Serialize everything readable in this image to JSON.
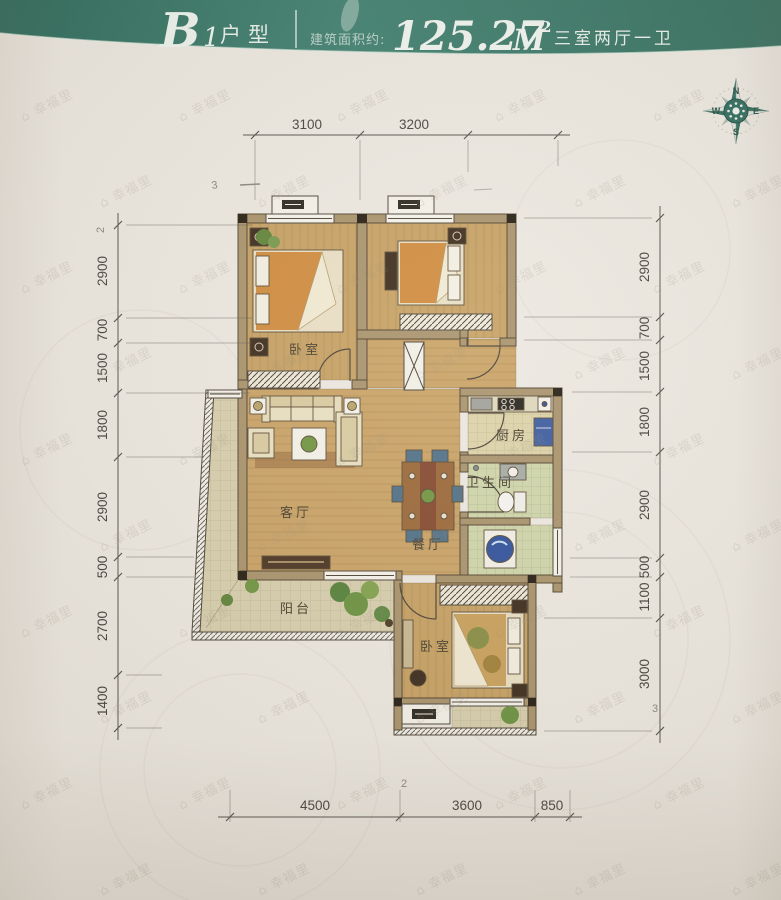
{
  "header": {
    "series_letter": "B",
    "series_number": "1",
    "series_suffix": "户型",
    "area_label": "建筑面积约:",
    "area_value": "125.27",
    "area_unit": "M",
    "area_exponent": "2",
    "rooms_summary": "三室两厅一卫",
    "band_color": "#35705f"
  },
  "compass": {
    "north": "N",
    "east": "E",
    "south": "S",
    "west": "W"
  },
  "watermark": {
    "text": "幸福里",
    "icon": "house-icon"
  },
  "rooms": {
    "bedroom_top_left": "卧室",
    "bedroom_bottom": "卧室",
    "living_room": "客厅",
    "dining_room": "餐厅",
    "kitchen": "厨房",
    "bathroom": "卫生间",
    "balcony": "阳台"
  },
  "dimensions": {
    "top": [
      "3100",
      "3200"
    ],
    "bottom": [
      "4500",
      "3600",
      "850"
    ],
    "left": [
      "2900",
      "700",
      "1500",
      "1800",
      "2900",
      "500",
      "2700",
      "1400"
    ],
    "right": [
      "2900",
      "700",
      "1500",
      "1800",
      "2900",
      "500",
      "1100",
      "3000"
    ]
  },
  "pencil_marks": [
    "3",
    "2",
    "2",
    "3"
  ],
  "colors": {
    "header_teal": "#35705f",
    "wall_tan": "#a8926a",
    "floor_wood": "#c9a264",
    "accent_blue": "#3a5a9e",
    "plant_green": "#69913f",
    "paper": "#ece8e0"
  }
}
